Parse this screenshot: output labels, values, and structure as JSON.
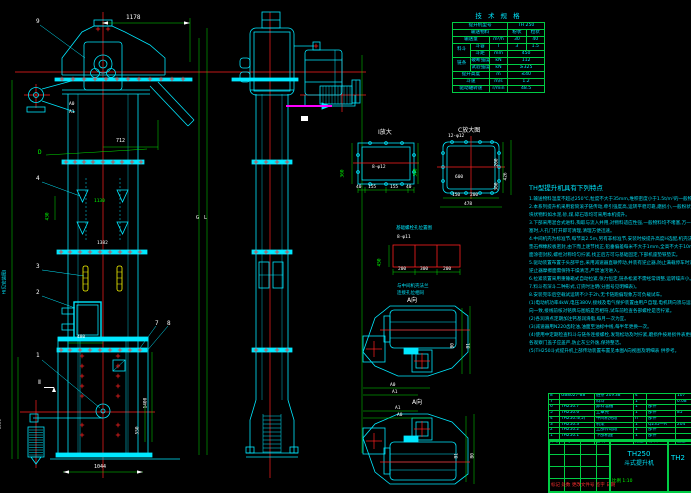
{
  "drawing": {
    "model": "TH250",
    "type_name": "斗式提升机"
  },
  "colors": {
    "geometry": "#00FFFF",
    "dimension": "#00FF00",
    "centerline": "#FF0000",
    "bucket": "#FFFF00",
    "highlight": "#FF00FF",
    "table_border": "#00CC44"
  },
  "front_view": {
    "d1178": "1178",
    "d712": "712",
    "d1130": "1130",
    "d1382": "1382",
    "d430": "430",
    "d480": "480",
    "d1400": "1400",
    "d550": "550",
    "d1044": "1044",
    "d1333": "1333",
    "h_note": "H(见安装图)",
    "b9": "9",
    "b4": "4",
    "b3": "3",
    "b2": "2",
    "b1": "1",
    "b7": "7",
    "b8": "8",
    "dD": "D",
    "a0": "A0",
    "a1": "A1",
    "G": "G",
    "L": "L",
    "sec2": "Ⅱ"
  },
  "details": {
    "i_title": "I放大",
    "i_holes": "8-φ12",
    "i_left": "360",
    "i_right": "300",
    "i_b1": "40",
    "i_b2": "155",
    "i_b3": "155",
    "i_b4": "40",
    "c_title": "C放大图",
    "c_holes": "12-φ12",
    "c_600": "600",
    "c_b1": "150",
    "c_b2": "200",
    "c_478": "478",
    "c_r1": "200",
    "c_r2": "300",
    "c_426": "426",
    "f_title": "基础螺栓孔位置图",
    "f_holes": "8-φ11",
    "f_450": "450",
    "f_b1": "200",
    "f_b2": "300",
    "f_b3": "200",
    "f_note1": "与中间机壳法兰",
    "f_note2": "连接孔位相同"
  },
  "plans": {
    "title1": "A向",
    "title2": "A向",
    "a0": "A0",
    "a1": "A1",
    "b0": "B0",
    "b1": "B1",
    "a1b": "A1",
    "a0b": "A0",
    "b1b": "B1",
    "b0b": "B0"
  },
  "spec": {
    "title": "技 术 规 格",
    "model_label": "提升机型号",
    "model": "TH 250",
    "material_label": "输送物料",
    "material_a": "粉状",
    "material_b": "粒状",
    "capacity_label": "输送量",
    "capacity_unit": "m³/h",
    "capacity_a": "30",
    "capacity_b": "40",
    "bucket_label": "料斗",
    "vol_label": "斗容",
    "vol_unit": "l",
    "vol_a": "3",
    "vol_b": "1.5",
    "pitch_label": "斗距",
    "pitch_unit": "mm",
    "pitch_val": "450",
    "chain_label": "链条",
    "break_label": "破断强度",
    "break_unit": "kN",
    "break_val": "112",
    "test_label": "试验强度",
    "test_unit": "kN",
    "test_val": "≥325",
    "height_label": "提升高度",
    "height_unit": "m",
    "height_val": "≤40",
    "speed_label": "斗速",
    "speed_unit": "m/s",
    "speed_val": "1.2",
    "rpm_label": "驱动轴转速",
    "rpm_unit": "r/min",
    "rpm_val": "48.5"
  },
  "notes": {
    "title": "TH型提升机具有下列特点",
    "lines": [
      "1.输送物料温度不超过250℃,粒度不大于35mm,堆积密度小于1.5t/m³的一般物料。",
      "2.本系列提升机采用套筒滚子链传动,牵引强度高,运转平稳可靠,磨损小,一般粉状及小",
      "  块状物料如水泥,砂,煤,碎石等均可采用本机提升。",
      "3.下部采用混合式进料,掏取与流入并用,对物料适应性强,一般物料均不堵塞,万一堵",
      "  塞时,人孔门打开即可清理,清理方便迅速。",
      "4.中间机壳为标准节,每节高2.5m,另有非标准节,安装时按提升高度H选配,机壳法兰间",
      "  垫石棉橡胶板密封,由下而上逐节找正,铅垂偏差每米不大于1mm,全高不大于10mm,法兰",
      "  面涂密封胶,螺栓对称均匀拧紧,找正后方可与基础固定,下部机座垫铁垫实。",
      "5.驱动装置布置于头部平台,采用减速器直联传动,并装有逆止器,防止满载停车时逆转,",
      "  逆止器摩擦面需保持干燥清洁,严禁油污进入。",
      "6.拉紧装置采用重锤箱式自动拉紧,张力恒定,链条松紧不需经常调整,运转噪声小。",
      "7.料斗有深斗二种形式,订货时注明(分图号见明细表)。",
      "8.安装完毕后空载试运转不少于2h,无卡链跑偏现象方可负载试车。",
      "",
      "(1)电动机功率4kW,电压380V,接线及电气保护装置由用户自理,电机转向须与运转方",
      "  向一致,接线前核对铭牌与图纸是否相符,试车前检查各部螺栓是否拧紧。",
      "(2)各润滑点定期加注钙基润滑脂,每月一次为宜。",
      "(3)减速器用N220齿轮油,油面至油标中线,每半年更换一次。",
      "(4)使用中定期检查料斗与链条连接螺栓,发现松动及时拧紧,磨损件按易损件表更换,",
      "  各观察门盖子应盖严,防止灰尘外逸,保持整洁。",
      "",
      "(5)TH250斗式提升机上部传动装置布置见本图A向视图及明细表 供参考。"
    ]
  },
  "bom": {
    "header": {
      "no": "件号",
      "code": "代  号",
      "name": "名  称",
      "qty": "数量",
      "mat": "材  料",
      "wt": "重量"
    },
    "rows": [
      {
        "no": "8",
        "code": "GB8027-88",
        "name": "链条 20×38",
        "qty": "4",
        "mat": "",
        "wt": "107"
      },
      {
        "no": "7",
        "code": "",
        "name": "料斗",
        "qty": "1",
        "mat": "",
        "wt": "0.08"
      },
      {
        "no": "6",
        "code": "TH250.7",
        "name": "卸料溜槽",
        "qty": "1",
        "mat": "部件",
        "wt": ""
      },
      {
        "no": "5",
        "code": "TH250.6",
        "name": "上罩壳",
        "qty": "1",
        "mat": "部件",
        "wt": "85"
      },
      {
        "no": "4",
        "code": "TH250.4(5)",
        "name": "中间机壳段",
        "qty": "n",
        "mat": "部件",
        "wt": ""
      },
      {
        "no": "3",
        "code": "TH250.3",
        "name": "机架",
        "qty": "1",
        "mat": "Q235—A",
        "wt": "204"
      },
      {
        "no": "2",
        "code": "TH250.2",
        "name": "上部传动段",
        "qty": "1",
        "mat": "部件",
        "wt": ""
      },
      {
        "no": "1",
        "code": "TH250.1",
        "name": "下部机座",
        "qty": "1",
        "mat": "部件",
        "wt": ""
      }
    ]
  },
  "title_block": {
    "model": "TH250",
    "product": "斗式提升机",
    "code_right": "TH2",
    "sign_row": "标记 处数 更改文件号 签字 日期",
    "scale": "比例 1:10"
  }
}
